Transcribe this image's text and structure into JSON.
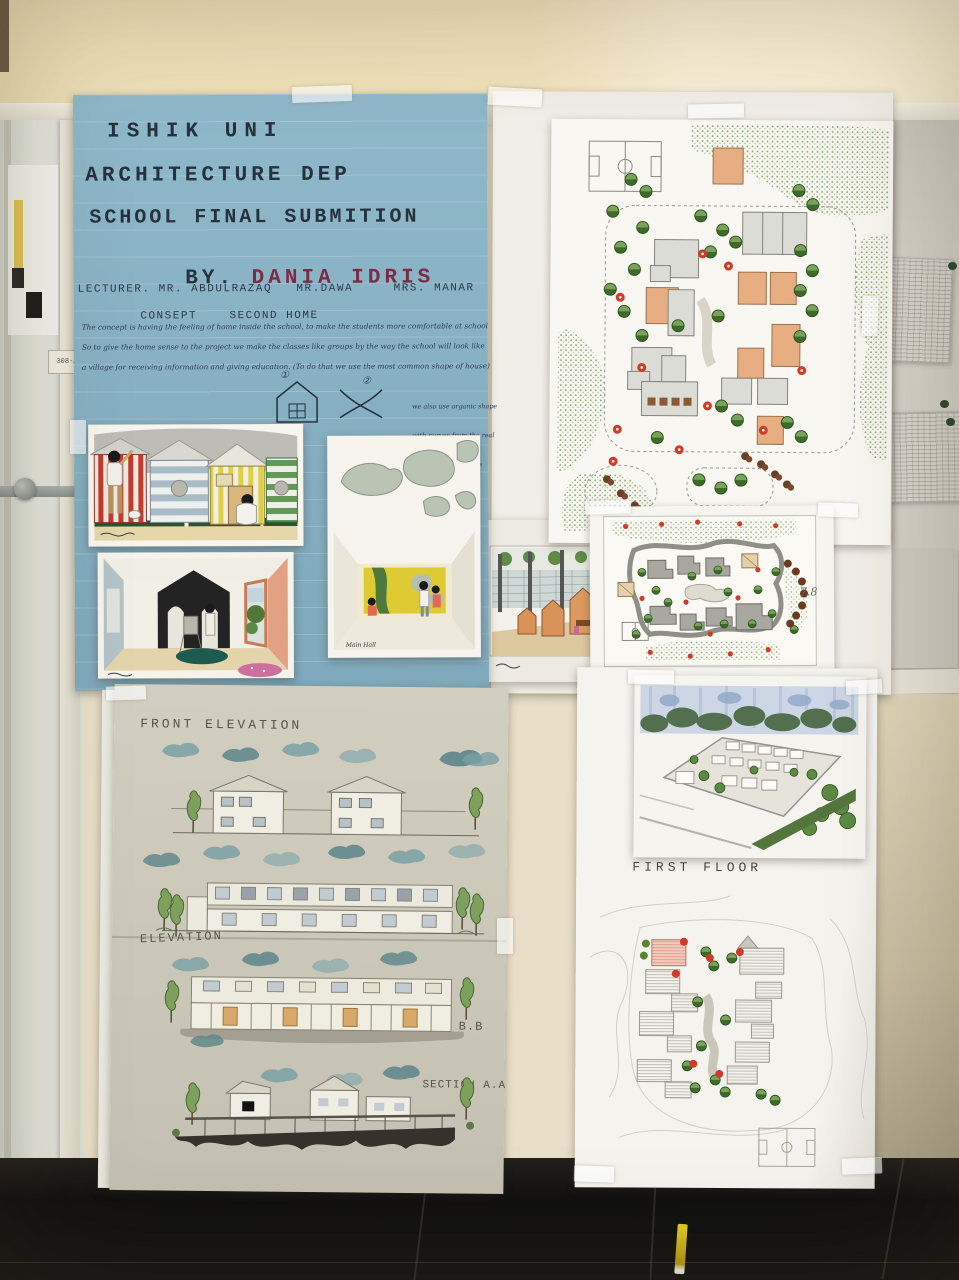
{
  "environment": {
    "door_tag": "308-A"
  },
  "blue_poster": {
    "line1": "ISHIK UNI",
    "line2": "ARCHITECTURE DEP",
    "line3": "SCHOOL FINAL SUBMITION",
    "by_label": "BY.",
    "author": "DANIA IDRIS",
    "lecturer_line": "LECTURER. MR. ABDULRAZAQ   MR.DAWA     MRS. MANAR",
    "concept_label": "CONSEPT",
    "concept_value": "SECOND HOME",
    "body_line1": "The concept is having the feeling of home inside the school, to make the students more comfortable at school",
    "body_line2": "So to give the home sense to the project we make the classes like groups by the way the school will look like",
    "body_line3": "a village for receiving information and giving education. (To do that we use the most common shape of house)",
    "marker1": "①",
    "marker2": "②",
    "side_note_line1": "we also use organic shape",
    "side_note_line2": "with curves from the real",
    "side_note_line3": "kurdish houses",
    "main_hall_caption": "Main Hall"
  },
  "elevation_poster": {
    "front_elevation_label": "FRONT ELEVATION",
    "elevation_label": "ELEVATION",
    "section_bb_label": "SECTION B.B",
    "section_aa_label": "SECTION A.A"
  },
  "right_posters": {
    "first_floor_label": "FIRST FLOOR",
    "grade_mark": "7.8"
  },
  "colors": {
    "blue_poster": "#8cb5c6",
    "title_ink": "#25323e",
    "author_ink": "#7b2c45",
    "beige_poster": "#cdc9ba",
    "wall": "#f2e4be",
    "floor": "#161616",
    "tree_green": "#55862f",
    "flower_red": "#c93a28",
    "building_orange": "#e2a87c",
    "building_gray": "#a3a39b"
  }
}
